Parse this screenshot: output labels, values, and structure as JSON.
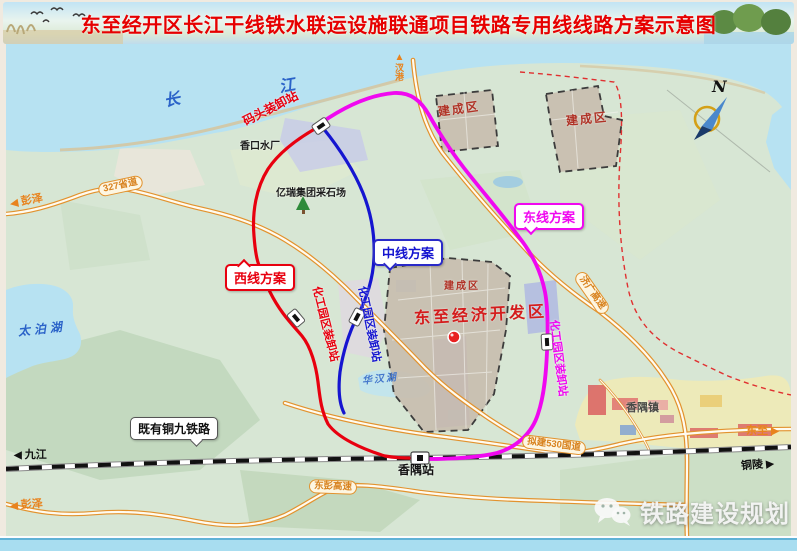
{
  "banner": {
    "title": "东至经开区长江干线铁水联运设施联通项目铁路专用线线路方案示意图"
  },
  "compass": {
    "label": "N"
  },
  "plan_labels": {
    "west": "西线方案",
    "middle": "中线方案",
    "east": "东线方案"
  },
  "railway_callout": "既有铜九铁路",
  "stations": {
    "dock": "码头装卸站",
    "chem_park_west": "化工园区装卸站",
    "chem_park_middle": "化工园区装卸站",
    "chem_park_east": "化工园区装卸站",
    "xiangyu": "香隅站"
  },
  "areas": {
    "built_up_1": "建成区",
    "built_up_2": "建成区",
    "built_up_3": "建成区",
    "dev_zone": "东至经济开发区",
    "xiangyu_town": "香隅镇"
  },
  "waters": {
    "river_char_1": "长",
    "river_char_2": "江",
    "taipo_lake": "太泊湖",
    "huahan_lake": "华汉湖"
  },
  "roads": {
    "s327": "327省道",
    "g530": "拟建530国道",
    "dongpeng_expwy": "东彭高速",
    "jiguang_expwy": "济广高速"
  },
  "directions": {
    "pengze_road": "彭泽",
    "pengze_expwy": "彭泽",
    "jiujiang": "九江",
    "dongzhi": "东至",
    "tongling": "铜陵",
    "chagang": "汊港"
  },
  "pois": {
    "water_plant": "香口水厂",
    "quarry": "亿瑞集团采石场"
  },
  "watermark": {
    "label": "铁路建设规划"
  },
  "icons": {
    "left_arrow": "◀",
    "right_arrow": "▶",
    "up_arrow": "▲"
  },
  "colors": {
    "west_line": "#e8000f",
    "middle_line": "#1515d0",
    "east_line": "#f008f0",
    "road_orange": "#e2922e",
    "title_red": "#e60000"
  }
}
